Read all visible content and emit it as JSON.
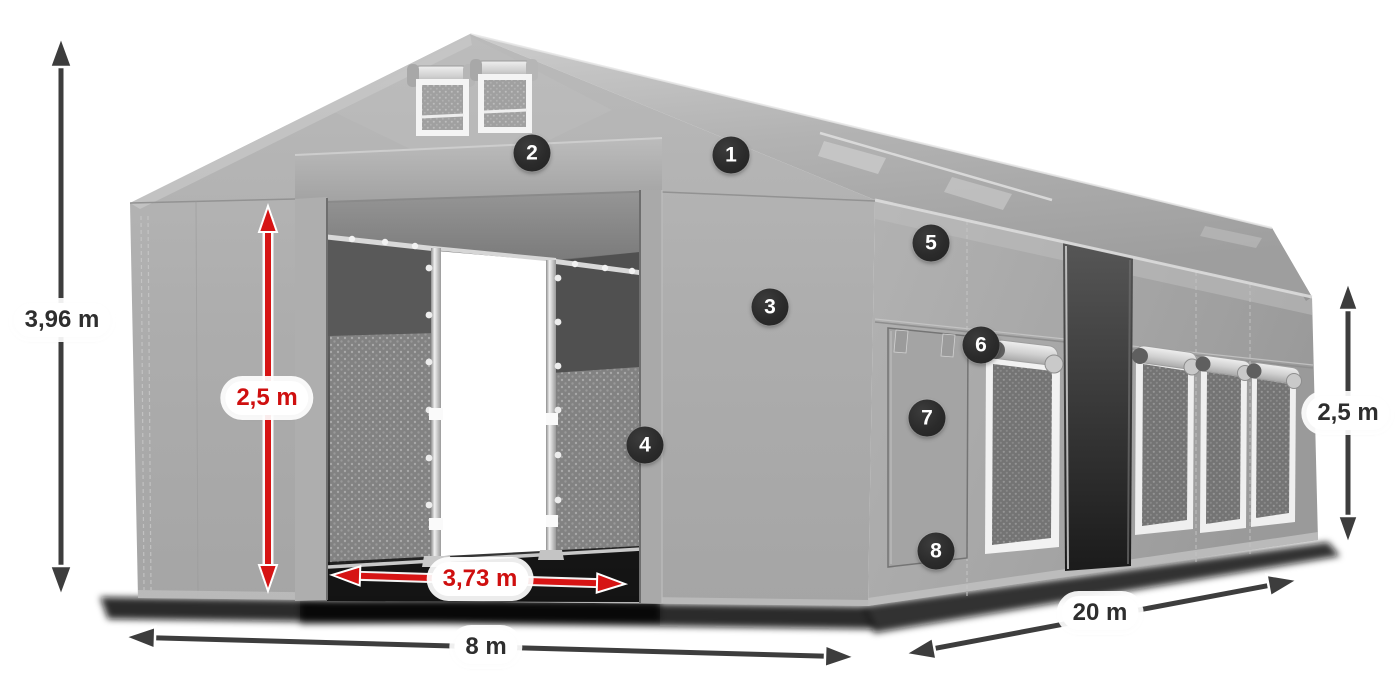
{
  "measurements": {
    "total_height": {
      "value": "3,96 m",
      "style": "dark"
    },
    "front_wall_height": {
      "value": "2,5 m",
      "style": "red"
    },
    "entrance_width": {
      "value": "3,73 m",
      "style": "red"
    },
    "width": {
      "value": "8 m",
      "style": "dark"
    },
    "length": {
      "value": "20 m",
      "style": "dark"
    },
    "side_wall_height": {
      "value": "2,5 m",
      "style": "dark"
    }
  },
  "callouts": {
    "items": [
      {
        "number": "1"
      },
      {
        "number": "2"
      },
      {
        "number": "3"
      },
      {
        "number": "4"
      },
      {
        "number": "5"
      },
      {
        "number": "6"
      },
      {
        "number": "7"
      },
      {
        "number": "8"
      }
    ]
  },
  "colors": {
    "accent_red": "#d61414",
    "arrow_dark": "#3d3d3d",
    "badge_background": "#2b2b2b",
    "tent_gray": "#a8a8a8"
  }
}
